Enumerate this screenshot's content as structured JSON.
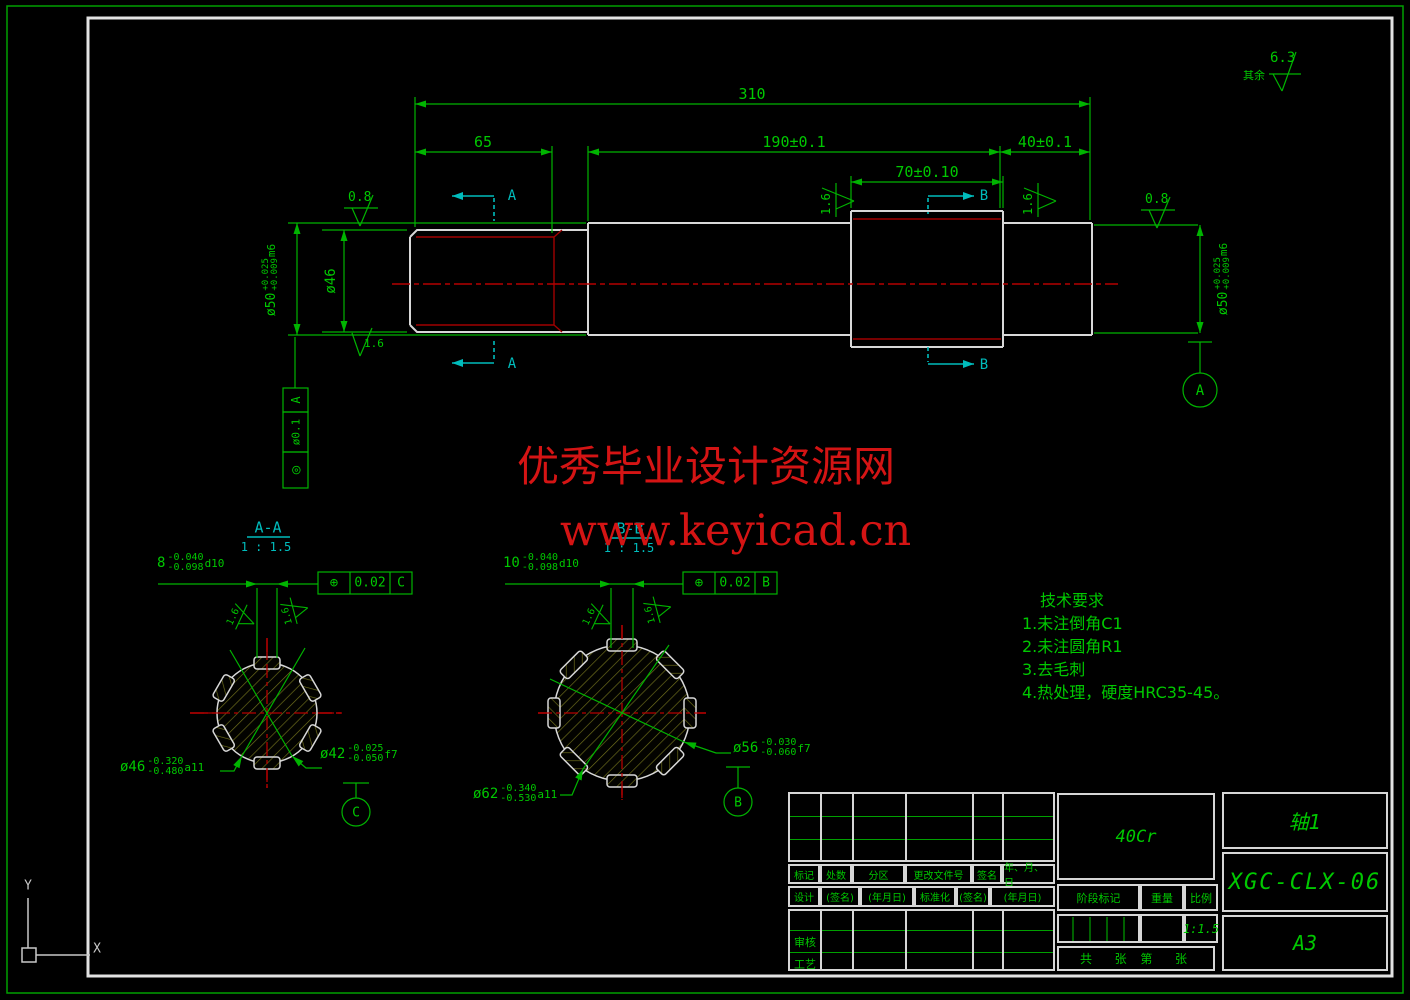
{
  "colors": {
    "line_green": "#00c800",
    "outline_white": "#d8d8d8",
    "centerline_red": "#b40000",
    "section_cyan": "#00bcbc",
    "watermark_red": "#d41414",
    "hatch_olive": "#72721c"
  },
  "general": {
    "surface_prefix": "其余",
    "surface_value": "6.3"
  },
  "dims": {
    "overall": "310",
    "seg_left": "65",
    "seg_mid": "190±0.1",
    "seg_right": "40±0.1",
    "spline_len": "70±0.10",
    "dia_mid": "ø46",
    "dia_journal": {
      "base": "ø50",
      "upper": "+0.025",
      "lower": "+0.009",
      "fit": "m6"
    },
    "rough_fine": "0.8",
    "rough_medium": "1.6"
  },
  "fcf_runout": {
    "symbol": "◎",
    "value": "ø0.1",
    "datum": "A"
  },
  "datums": {
    "a": "A",
    "b": "B",
    "c": "C"
  },
  "cut_labels": {
    "a": "A",
    "b": "B"
  },
  "section_a": {
    "title": "A-A",
    "scale": "1 : 1.5",
    "keyway": {
      "base": "8",
      "upper": "-0.040",
      "lower": "-0.098",
      "fit": "d10"
    },
    "fcf": {
      "symbol": "⊕",
      "value": "0.02",
      "datum": "C"
    },
    "dia_outer": {
      "base": "ø46",
      "upper": "-0.320",
      "lower": "-0.480",
      "fit": "a11"
    },
    "dia_root": {
      "base": "ø42",
      "upper": "-0.025",
      "lower": "-0.050",
      "fit": "f7"
    }
  },
  "section_b": {
    "title": "B-B",
    "scale": "1 : 1.5",
    "keyway": {
      "base": "10",
      "upper": "-0.040",
      "lower": "-0.098",
      "fit": "d10"
    },
    "fcf": {
      "symbol": "⊕",
      "value": "0.02",
      "datum": "B"
    },
    "dia_outer": {
      "base": "ø62",
      "upper": "-0.340",
      "lower": "-0.530",
      "fit": "a11"
    },
    "dia_root": {
      "base": "ø56",
      "upper": "-0.030",
      "lower": "-0.060",
      "fit": "f7"
    }
  },
  "tech_req": {
    "title": "技术要求",
    "items": [
      "1.未注倒角C1",
      "2.未注圆角R1",
      "3.去毛刺",
      "4.热处理，硬度HRC35-45。"
    ]
  },
  "watermark": {
    "line1": "优秀毕业设计资源网",
    "line2": "www.keyicad.cn"
  },
  "title_block": {
    "rev_cols": [
      "标记",
      "处数",
      "分区",
      "更改文件号",
      "签名",
      "年、月、日"
    ],
    "sign_cols": [
      "设计",
      "(签名)",
      "(年月日)",
      "标准化",
      "(签名)",
      "(年月日)"
    ],
    "check": "审核",
    "process": "工艺",
    "stage_label": "阶段标记",
    "weight_label": "重量",
    "scale_label": "比例",
    "scale_value": "1:1.5",
    "sheets": "共  张 第  张",
    "material": "40Cr",
    "part_name": "轴1",
    "drawing_no": "XGC-CLX-06",
    "sheet_size": "A3"
  },
  "ucs": {
    "x_label": "X",
    "y_label": "Y"
  }
}
